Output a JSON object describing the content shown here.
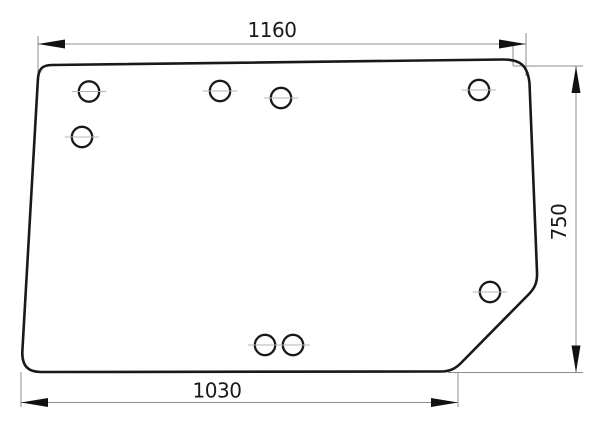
{
  "meta": {
    "title": "Technical drawing of glazing panel with mounting holes",
    "units": "mm"
  },
  "canvas": {
    "width": 600,
    "height": 438,
    "background": "#ffffff"
  },
  "style": {
    "outline_color": "#191919",
    "outline_width": 2.6,
    "hole_stroke_color": "#191919",
    "hole_stroke_width": 2.3,
    "hole_fill": "#ffffff",
    "dimension_line_color": "#8c8c8c",
    "dimension_line_width": 1,
    "centerline_color": "#b4b4b4",
    "centerline_width": 1,
    "arrow_color": "#111111",
    "arrow_length": 27,
    "arrow_half_width": 4.5,
    "label_color": "#1a1a1a",
    "label_font_size": 20
  },
  "panel": {
    "name": "glass-panel-outline",
    "outline_path": "M 52 65 L 503 59.5 C 520 59.5 527.5 65 529.5 83 L 537 272 C 537.5 282 535 288 528.5 294.5 L 461 363 C 455.5 368.5 450 371.5 441 371.5 L 41 372 C 28.5 372 22 366.5 22.3 352 L 37.8 81 C 38.2 69 42 65 52 65 Z",
    "centerline_overhang": 7,
    "holes": [
      {
        "cx": 89,
        "cy": 91.5,
        "r": 10.2
      },
      {
        "cx": 82,
        "cy": 137,
        "r": 10.2
      },
      {
        "cx": 220,
        "cy": 91,
        "r": 10.2
      },
      {
        "cx": 281,
        "cy": 98,
        "r": 10.2
      },
      {
        "cx": 479,
        "cy": 90,
        "r": 10.2
      },
      {
        "cx": 490,
        "cy": 292,
        "r": 10.2
      },
      {
        "cx": 265,
        "cy": 345,
        "r": 10.2
      },
      {
        "cx": 293,
        "cy": 345,
        "r": 10.2
      }
    ]
  },
  "dimensions": [
    {
      "id": "top-width",
      "label": "1160",
      "line": [
        38,
        44,
        526,
        44
      ],
      "arrows": [
        {
          "tip": [
            38,
            44
          ],
          "dir": "left"
        },
        {
          "tip": [
            526,
            44
          ],
          "dir": "right"
        }
      ],
      "extensions": [
        [
          38,
          36,
          38,
          80
        ],
        [
          526,
          33,
          526,
          76
        ],
        [
          513,
          44,
          513,
          66
        ]
      ],
      "label_pos": [
        272,
        37
      ],
      "label_rotate": 0
    },
    {
      "id": "bottom-width",
      "label": "1030",
      "line": [
        21,
        402.5,
        458,
        402.5
      ],
      "arrows": [
        {
          "tip": [
            21,
            402.5
          ],
          "dir": "left"
        },
        {
          "tip": [
            458,
            402.5
          ],
          "dir": "right"
        }
      ],
      "extensions": [
        [
          21,
          372,
          21,
          407
        ],
        [
          458,
          373,
          458,
          407
        ]
      ],
      "label_pos": [
        217,
        397.5
      ],
      "label_rotate": 0
    },
    {
      "id": "right-height",
      "label": "750",
      "line": [
        576,
        66,
        576,
        372.5
      ],
      "arrows": [
        {
          "tip": [
            576,
            66
          ],
          "dir": "up"
        },
        {
          "tip": [
            576,
            372.5
          ],
          "dir": "down"
        }
      ],
      "extensions": [
        [
          513,
          66,
          583,
          66
        ],
        [
          448,
          372.5,
          583,
          372.5
        ]
      ],
      "label_pos": [
        566,
        222
      ],
      "label_rotate": -90
    }
  ]
}
